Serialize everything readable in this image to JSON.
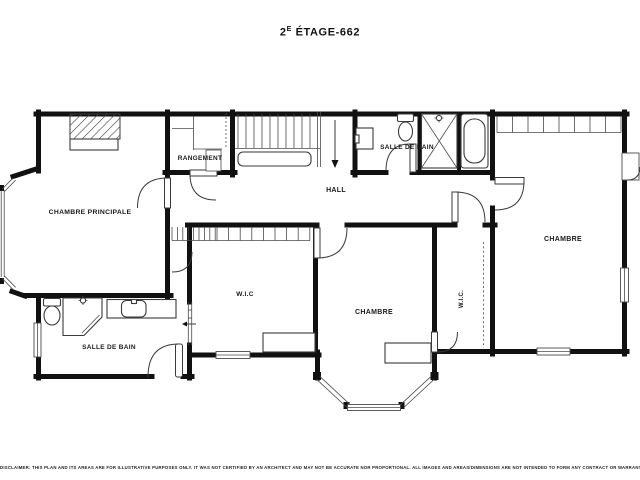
{
  "title": {
    "number": "2",
    "superscript": "E",
    "rest": " ÉTAGE-662"
  },
  "rooms": {
    "chambre_principale": "CHAMBRE PRINCIPALE",
    "rangement": "RANGEMENT",
    "salle_de_bain_haut": "SALLE DE BAIN",
    "hall": "HALL",
    "wic_centre": "W.I.C",
    "chambre_centre": "CHAMBRE",
    "wic_droit": "W.I.C.",
    "chambre_droite": "CHAMBRE",
    "salle_de_bain_bas": "SALLE DE BAIN"
  },
  "icons": [
    "toilet-icon",
    "sink-icon",
    "vanity-sink-icon",
    "shower-icon",
    "corner-shower-icon",
    "shower-head-icon",
    "bathtub-icon",
    "stairs-down-arrow-icon",
    "slide-arrow-icon"
  ],
  "disclaimer": "DISCLAIMER: THIS PLAN AND ITS AREAS ARE FOR ILLUSTRATIVE PURPOSES ONLY. IT WAS NOT CERTIFIED BY AN ARCHITECT AND MAY NOT BE ACCURATE NOR PROPORTIONAL. ALL IMAGES AND AREAS/DIMENSIONS ARE NOT INTENDED TO FORM ANY CONTRACT OR WARRANTY.",
  "colors": {
    "wall": "#111111",
    "fixture_line": "#3a3a3a",
    "text": "#1a1a1a",
    "background": "#ffffff"
  }
}
